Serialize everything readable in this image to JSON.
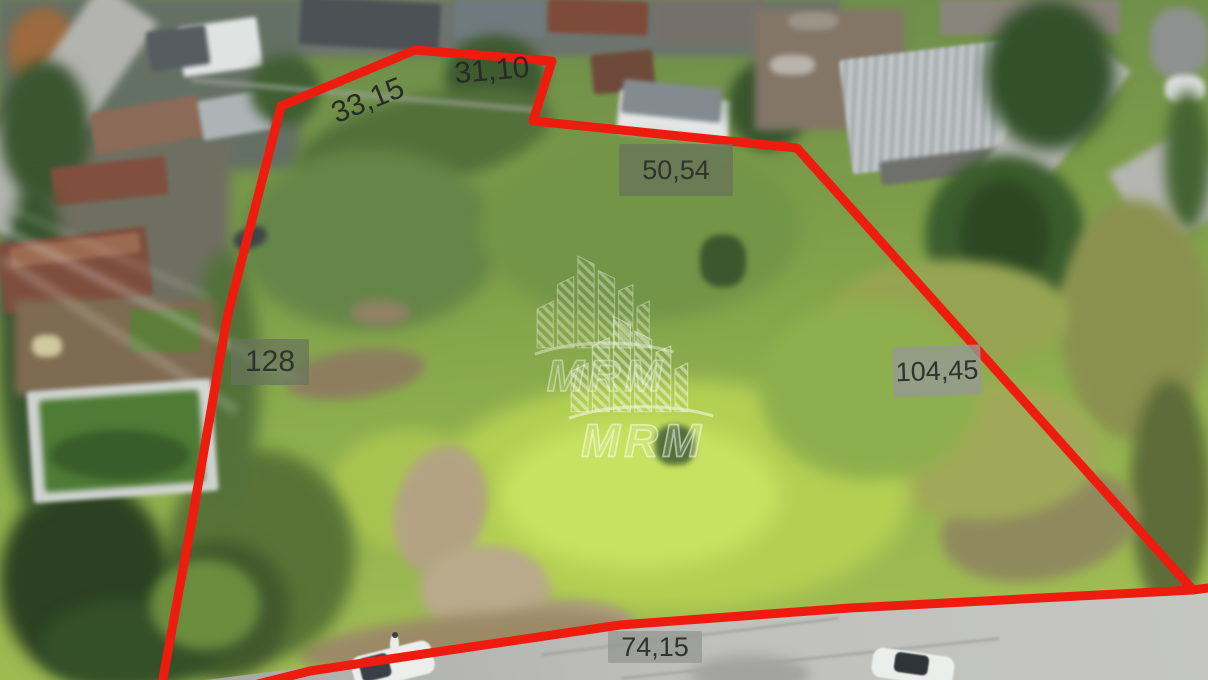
{
  "scene": {
    "type": "aerial-drone-photo-of-land-plot",
    "boundary_shape": "irregular-polygon-red-outline"
  },
  "watermark": {
    "text": "MRM"
  },
  "measurements": [
    {
      "id": "side-top-left",
      "text": "33,15"
    },
    {
      "id": "side-top-notch",
      "text": "31,10"
    },
    {
      "id": "side-top-right",
      "text": "50,54"
    },
    {
      "id": "side-left",
      "text": "128"
    },
    {
      "id": "side-right",
      "text": "104,45"
    },
    {
      "id": "side-bottom",
      "text": "74,15"
    }
  ],
  "colors": {
    "boundary": "#ee1b0f",
    "label_text": "#2e332e",
    "label_box_olive": "#68735c",
    "label_box_gray": "#96988f",
    "watermark_white": "#ffffff"
  }
}
